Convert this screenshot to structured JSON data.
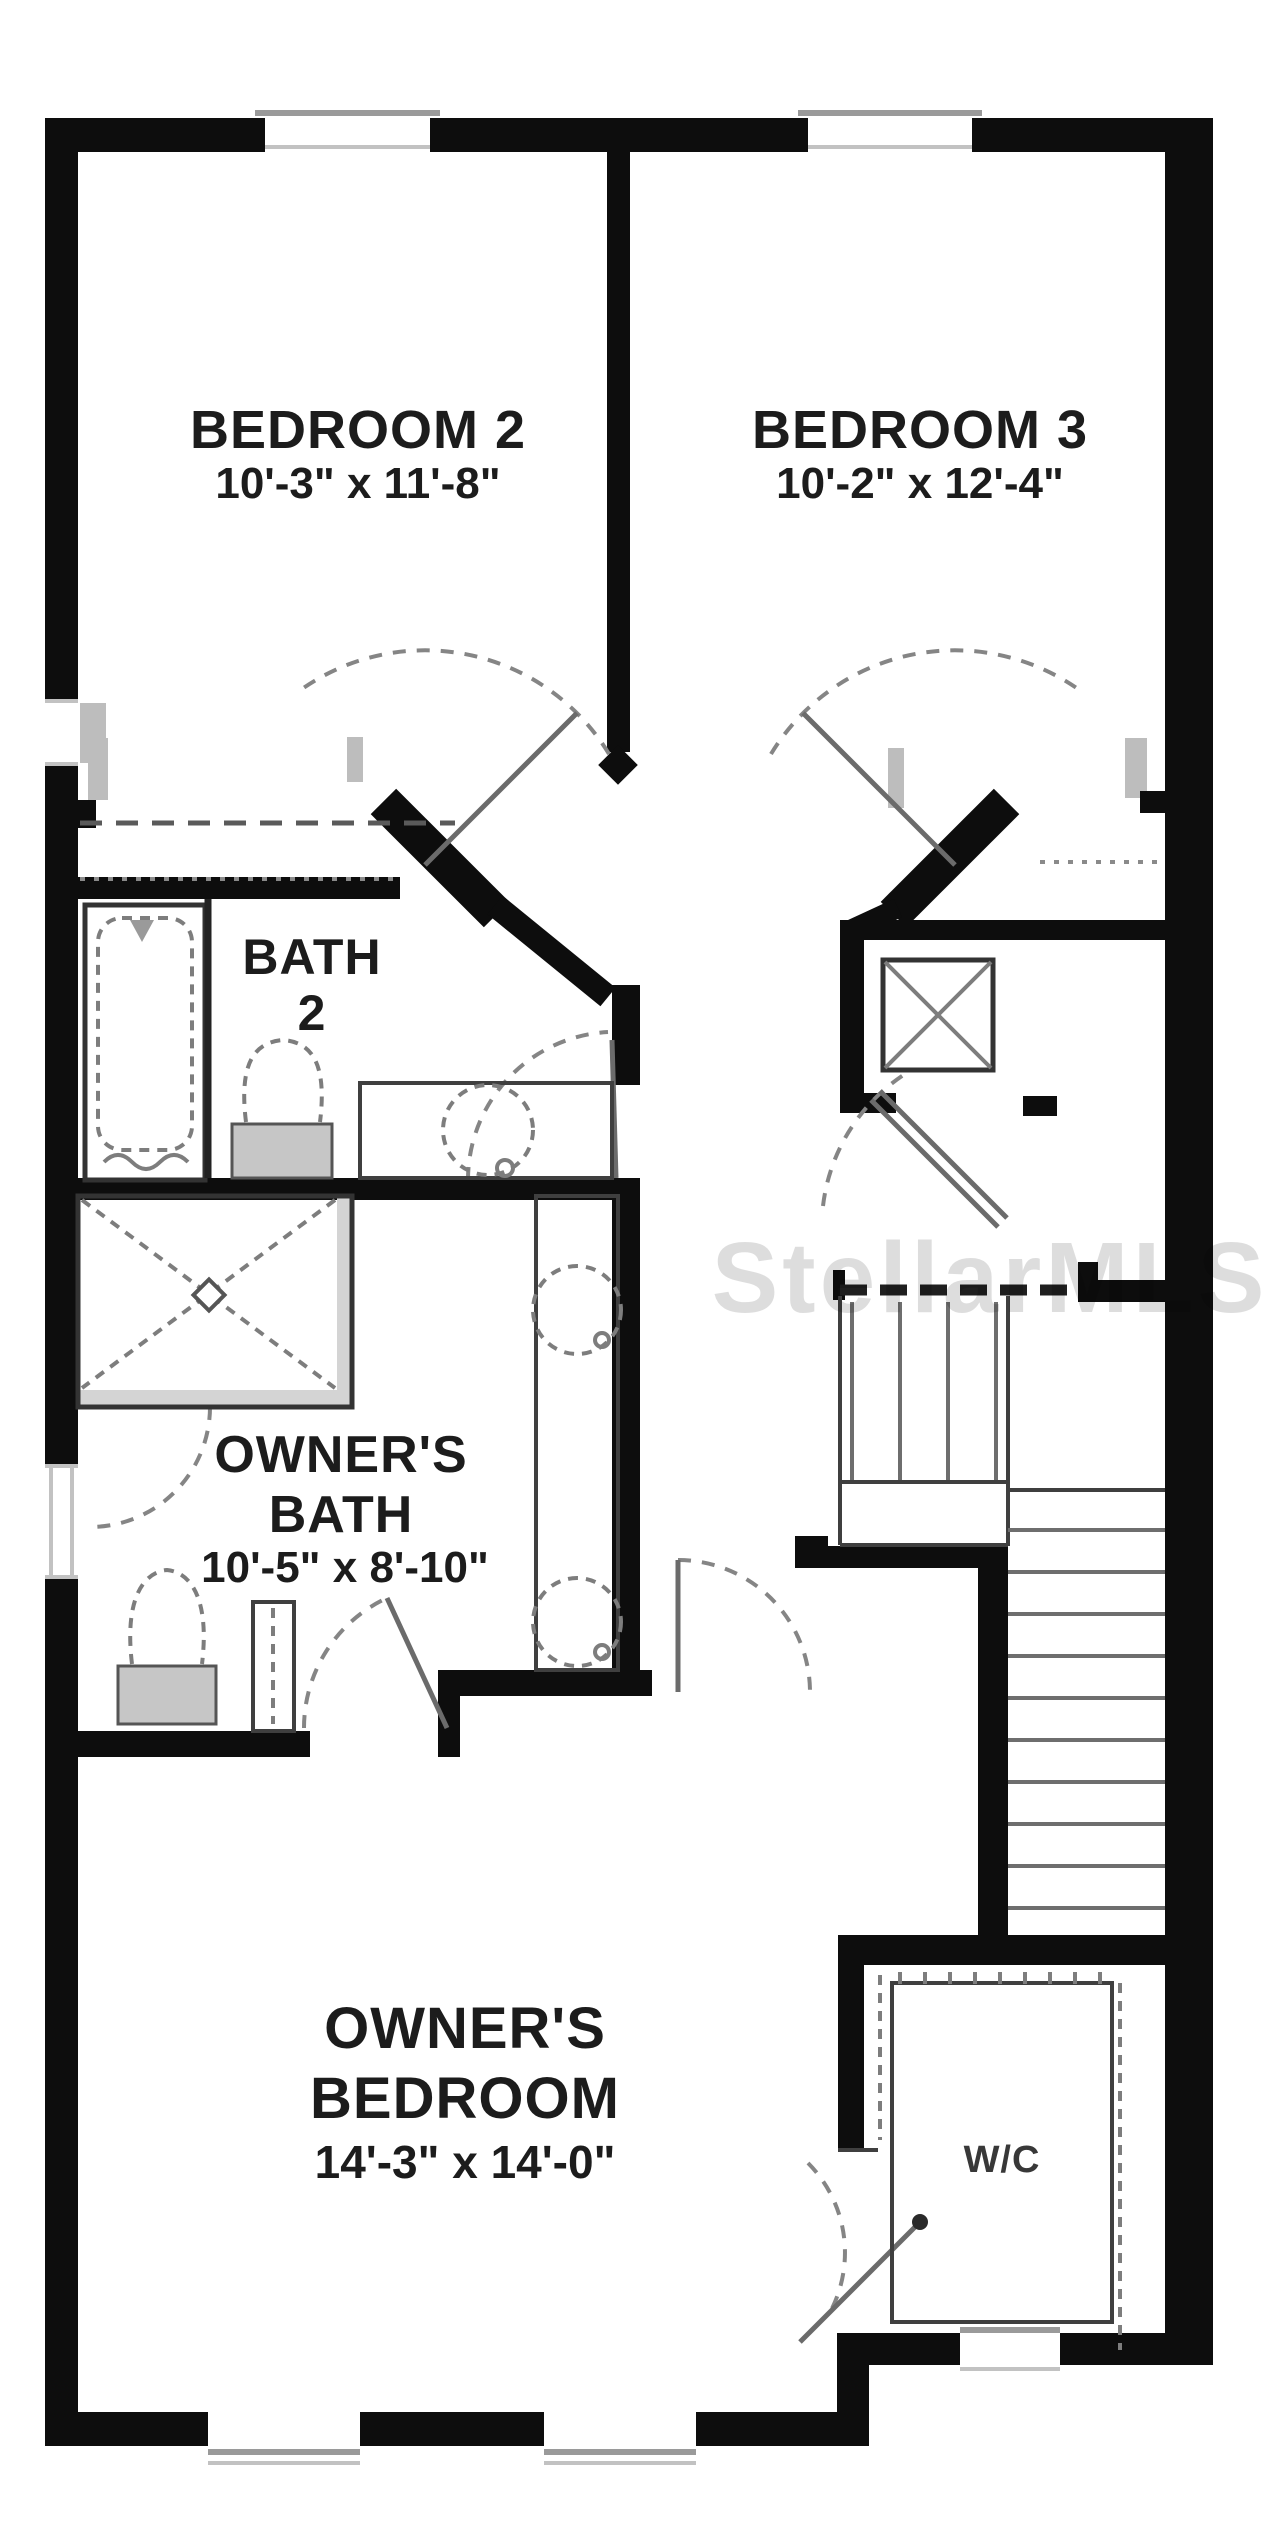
{
  "meta": {
    "type": "floor-plan",
    "floor": "second-floor",
    "watermark": "StellarMLS"
  },
  "colors": {
    "wall": "#0d0d0d",
    "line": "#3f3f3f",
    "fixture": "#7d7d7d",
    "grayfill": "#bdbdbd",
    "curb": "#d4d4d4",
    "text": "#1c1c1c",
    "background": "#ffffff"
  },
  "rooms": {
    "bedroom2": {
      "name": "BEDROOM 2",
      "dims": "10'-3\" x 11'-8\""
    },
    "bedroom3": {
      "name": "BEDROOM 3",
      "dims": "10'-2\" x 12'-4\""
    },
    "bath2": {
      "name_line1": "BATH",
      "name_line2": "2"
    },
    "owners_bath": {
      "name_line1": "OWNER'S",
      "name_line2": "BATH",
      "dims": "10'-5\" x 8'-10\""
    },
    "owners_bedroom": {
      "name_line1": "OWNER'S",
      "name_line2": "BEDROOM",
      "dims": "14'-3\" x 14'-0\""
    },
    "wc": {
      "name": "W/C"
    }
  },
  "fixtures": [
    "bathtub",
    "toilet-bath2",
    "vanity-sink-bath2",
    "walk-in-shower",
    "double-vanity-owners-bath",
    "toilet-owners-bath",
    "linen-cabinet",
    "linen-closet-x",
    "staircase-upper-flight",
    "stair-landing",
    "staircase-lower-flight",
    "closet-rod-wc"
  ]
}
